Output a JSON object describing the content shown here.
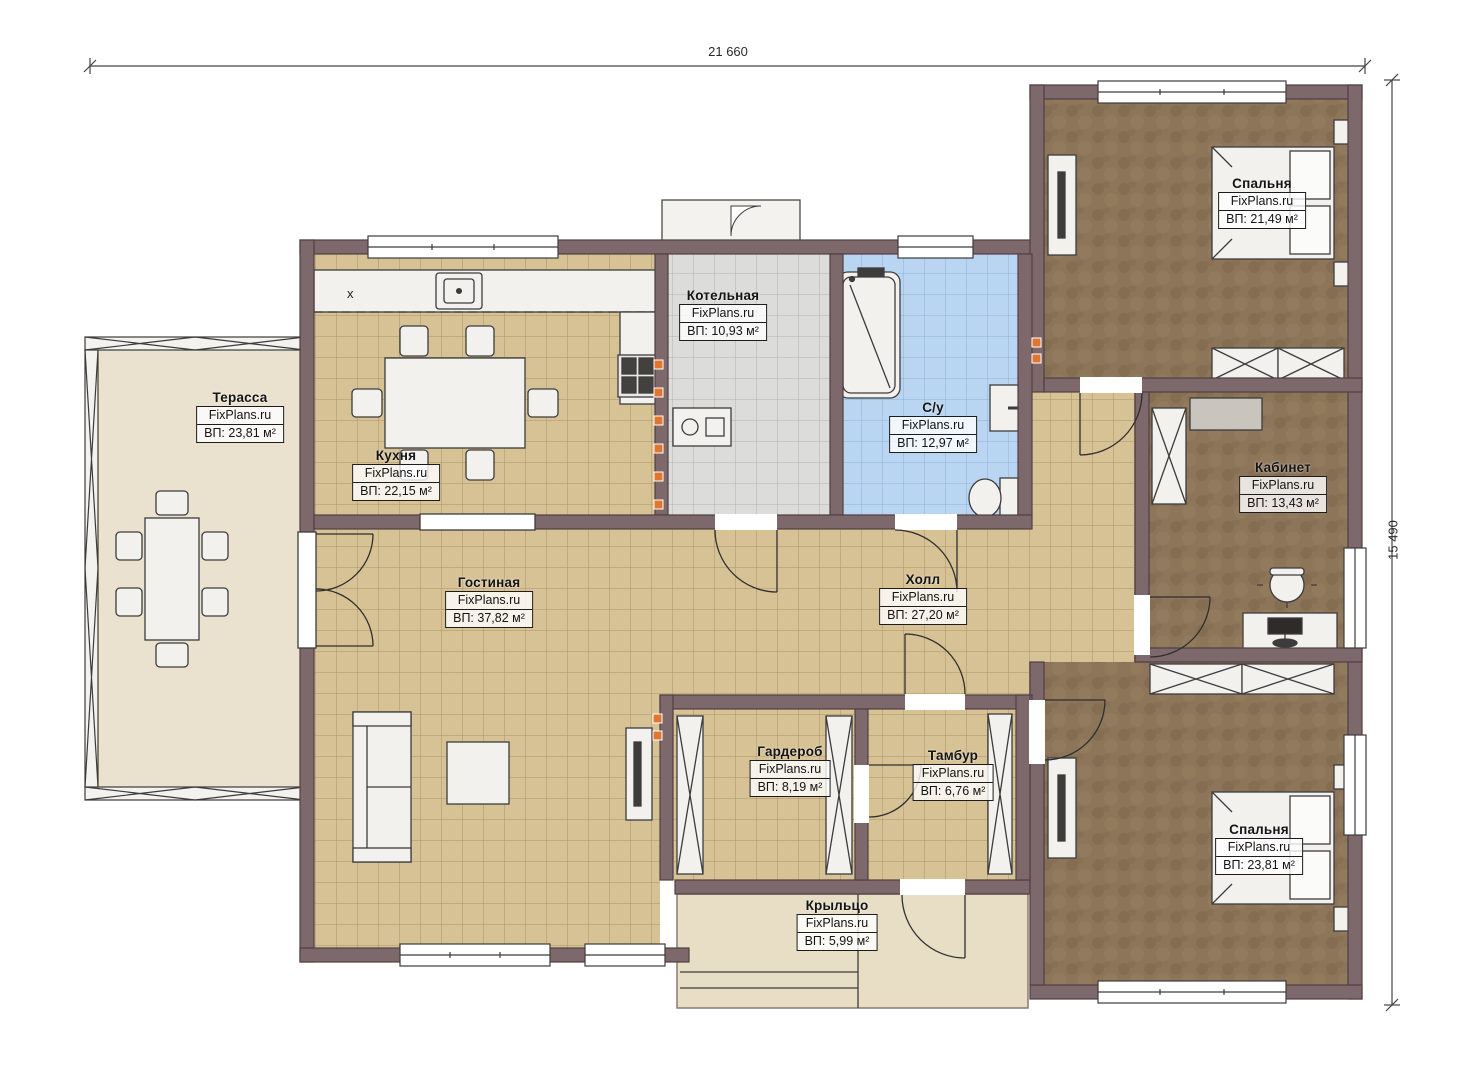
{
  "watermark": "FixPlans.ru",
  "dimensions": {
    "width_label": "21 660",
    "height_label": "15 490"
  },
  "kitchen_counter_mark": "x",
  "rooms": [
    {
      "id": "terrace",
      "name": "Терасса",
      "area": "ВП: 23,81 м²"
    },
    {
      "id": "kitchen",
      "name": "Кухня",
      "area": "ВП: 22,15 м²"
    },
    {
      "id": "boiler",
      "name": "Котельная",
      "area": "ВП: 10,93 м²"
    },
    {
      "id": "bathroom",
      "name": "С/у",
      "area": "ВП: 12,97 м²"
    },
    {
      "id": "bedroom-top",
      "name": "Спальня",
      "area": "ВП: 21,49 м²"
    },
    {
      "id": "office",
      "name": "Кабинет",
      "area": "ВП: 13,43 м²"
    },
    {
      "id": "living-room",
      "name": "Гостиная",
      "area": "ВП: 37,82 м²"
    },
    {
      "id": "hall",
      "name": "Холл",
      "area": "ВП: 27,20 м²"
    },
    {
      "id": "wardrobe-room",
      "name": "Гардероб",
      "area": "ВП: 8,19 м²"
    },
    {
      "id": "vestibule",
      "name": "Тамбур",
      "area": "ВП: 6,76 м²"
    },
    {
      "id": "bedroom-bottom",
      "name": "Спальня",
      "area": "ВП: 23,81 м²"
    },
    {
      "id": "porch",
      "name": "Крыльцо",
      "area": "ВП: 5,99 м²"
    }
  ],
  "colors": {
    "wall": "#7d686c",
    "wall_stroke": "#4f3f43",
    "tile_tan": "#d7c295",
    "tile_gray": "#dcdcda",
    "tile_blue": "#b9d5f1",
    "carpet_brown": "#8d755a",
    "terrace_floor": "#eae1cf",
    "porch_floor": "#e8dec6",
    "outlet_orange": "#e0762f"
  }
}
